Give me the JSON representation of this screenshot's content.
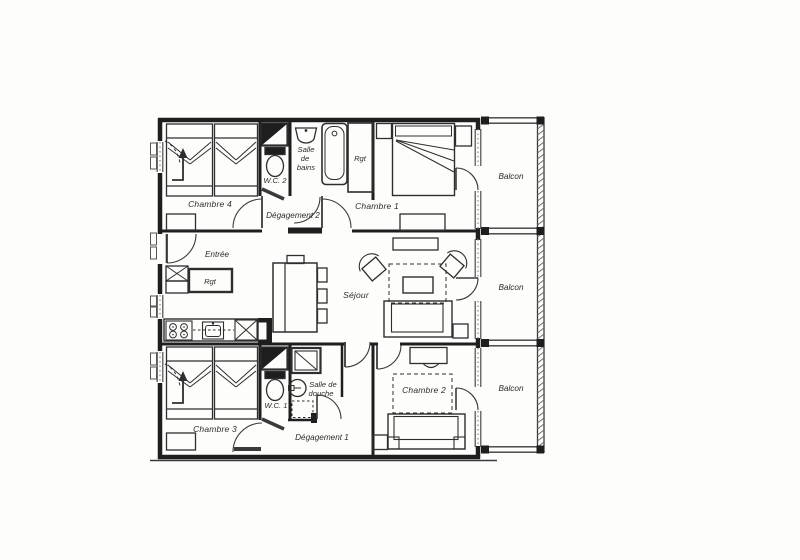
{
  "document": {
    "kind": "apartment floor plan (scanned drawing)",
    "colors": {
      "paper": "#fdfdfc",
      "wall_ink": "#1e1e1e",
      "furniture_ink": "#2e2e2e",
      "window_ink": "#4a4a4a",
      "hatch": "#6e6e6e",
      "label_ink": "#2b2b2b"
    }
  },
  "plan": {
    "rooms": [
      {
        "id": "chambre-4",
        "label": "Chambre 4"
      },
      {
        "id": "wc-2",
        "label": "W.C. 2"
      },
      {
        "id": "salle-de-bains",
        "label": "Salle de bains",
        "lines": [
          "Salle",
          "de",
          "bains"
        ]
      },
      {
        "id": "rangement-haut",
        "label": "Rgt"
      },
      {
        "id": "chambre-1",
        "label": "Chambre 1"
      },
      {
        "id": "degagement-2",
        "label": "Dégagement 2"
      },
      {
        "id": "entree",
        "label": "Entrée"
      },
      {
        "id": "rangement-entree",
        "label": "Rgt"
      },
      {
        "id": "sejour",
        "label": "Séjour"
      },
      {
        "id": "chambre-3",
        "label": "Chambre 3"
      },
      {
        "id": "wc-1",
        "label": "W.C. 1"
      },
      {
        "id": "salle-de-douche",
        "label": "Salle de douche",
        "lines": [
          "Salle de",
          "douche"
        ]
      },
      {
        "id": "degagement-1",
        "label": "Dégagement 1"
      },
      {
        "id": "chambre-2",
        "label": "Chambre 2"
      },
      {
        "id": "balcon-1",
        "label": "Balcon"
      },
      {
        "id": "balcon-2",
        "label": "Balcon"
      },
      {
        "id": "balcon-3",
        "label": "Balcon"
      }
    ],
    "furniture": [
      {
        "room": "chambre-4",
        "items": [
          "twin-bed",
          "twin-bed",
          "bedside-table",
          "window",
          "entry-arrow"
        ]
      },
      {
        "room": "wc-2",
        "items": [
          "shelf",
          "toilet"
        ]
      },
      {
        "room": "salle-de-bains",
        "items": [
          "washbasin",
          "bathtub"
        ]
      },
      {
        "room": "rangement-haut",
        "items": [
          "closet"
        ]
      },
      {
        "room": "chambre-1",
        "items": [
          "double-bed",
          "bedside-table",
          "bedside-table",
          "desk",
          "balcony-door"
        ]
      },
      {
        "room": "entree",
        "items": [
          "entry-door",
          "crossed-cabinet",
          "cabinet",
          "storage-Rgt"
        ]
      },
      {
        "room": "cuisine",
        "items": [
          "counter",
          "cooktop-4-burners",
          "kitchen-sink",
          "refrigerator",
          "dining-table",
          "chair",
          "chair",
          "chair",
          "chair"
        ]
      },
      {
        "room": "sejour",
        "items": [
          "sideboard",
          "armchair",
          "armchair",
          "rug",
          "coffee-table",
          "sofa",
          "side-table",
          "balcony-door"
        ]
      },
      {
        "room": "chambre-3",
        "items": [
          "twin-bed",
          "twin-bed",
          "bedside-table",
          "window",
          "entry-arrow"
        ]
      },
      {
        "room": "wc-1",
        "items": [
          "shelf",
          "toilet"
        ]
      },
      {
        "room": "salle-de-douche",
        "items": [
          "shower",
          "washbasin"
        ]
      },
      {
        "room": "chambre-2",
        "items": [
          "desk",
          "chair",
          "rug",
          "sofa-bed",
          "bedside-table",
          "balcony-door"
        ]
      },
      {
        "room": "balcons",
        "items": [
          "railing",
          "railing",
          "railing"
        ]
      }
    ]
  }
}
